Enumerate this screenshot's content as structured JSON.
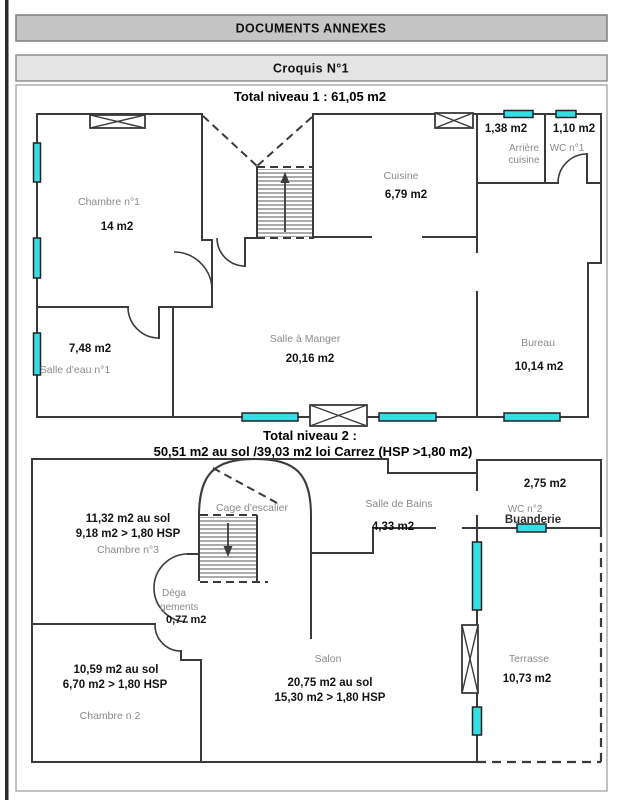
{
  "header": {
    "title": "DOCUMENTS ANNEXES",
    "subtitle": "Croquis N°1"
  },
  "level1": {
    "title": "Total niveau 1 : 61,05 m2",
    "chambre1": {
      "name": "Chambre n°1",
      "area": "14 m2"
    },
    "cuisine": {
      "name": "Cuisine",
      "area": "6,79 m2"
    },
    "arriere_cuisine": {
      "area": "1,38 m2",
      "name_line1": "Arrière",
      "name_line2": "cuisine"
    },
    "wc1": {
      "area": "1,10 m2",
      "name": "WC n°1"
    },
    "salle_a_manger": {
      "name": "Salle à Manger",
      "area": "20,16 m2"
    },
    "salle_eau": {
      "area": "7,48 m2",
      "name": "Salle d'eau n°1"
    },
    "bureau": {
      "name": "Bureau",
      "area": "10,14 m2"
    }
  },
  "level2": {
    "title_line1": "Total niveau 2 :",
    "title_line2": "50,51 m2 au sol /39,03 m2 loi Carrez (HSP >1,80 m2)",
    "chambre3": {
      "area_sol": "11,32 m2 au sol",
      "area_hsp": "9,18 m2 > 1,80 HSP",
      "name": "Chambre n°3"
    },
    "cage_escalier": {
      "name": "Cage d'escalier"
    },
    "salle_de_bains": {
      "name": "Salle de Bains",
      "area": "4,33 m2"
    },
    "wc2": {
      "area": "2,75 m2",
      "name": "WC n°2"
    },
    "buanderie": {
      "name": "Buanderie"
    },
    "degagements": {
      "name_line1": "Déga",
      "name_line2": "gements",
      "area": "0,77 m2"
    },
    "chambre2": {
      "area_sol": "10,59 m2 au sol",
      "area_hsp": "6,70 m2 > 1,80 HSP",
      "name": "Chambre n 2"
    },
    "salon": {
      "name": "Salon",
      "area_sol": "20,75 m2 au sol",
      "area_hsp": "15,30 m2 > 1,80 HSP"
    },
    "terrasse": {
      "name": "Terrasse",
      "area": "10,73 m2"
    }
  },
  "colors": {
    "window_fill": "#35DDE5",
    "terrace_area_text": "#579B3B",
    "wall": "#3a3a3a",
    "room_label": "#8a8a8a",
    "header_bar": "#c5c5c5",
    "subheader_bar": "#e4e4e4"
  }
}
